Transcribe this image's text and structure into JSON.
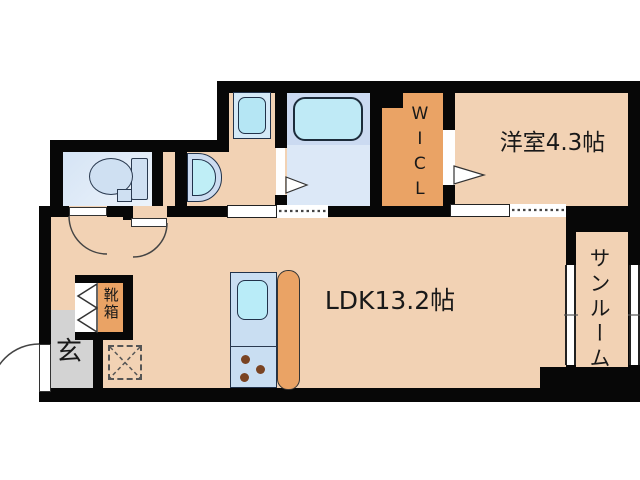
{
  "floorplan": {
    "type": "apartment-floor-plan",
    "labels": {
      "ldk": "LDK13.2帖",
      "western_room": "洋室4.3帖",
      "wicl": "WICL",
      "sunroom": "サンルーム",
      "entrance": "玄",
      "shoe_box": "靴箱"
    },
    "rooms": [
      {
        "name": "LDK",
        "size_tatami": "13.2帖"
      },
      {
        "name": "洋室",
        "size_tatami": "4.3帖"
      },
      {
        "name": "WICL (walk-in closet)",
        "size_tatami": ""
      },
      {
        "name": "サンルーム (sunroom)",
        "size_tatami": ""
      },
      {
        "name": "玄関 (entrance)",
        "size_tatami": ""
      }
    ],
    "fixtures": [
      "toilet",
      "wash-basin",
      "washing-machine-pan",
      "bathtub",
      "kitchen-sink-unit",
      "gas-stove-burners",
      "kitchen-counter",
      "refrigerator-space",
      "shoe-box",
      "entrance-door",
      "bifold-closet-door",
      "hinged-doors",
      "sliding-doors",
      "windows"
    ],
    "colors": {
      "wall": "#070707",
      "room_floor": "#f2d2b4",
      "closet_orange": "#eaa365",
      "entrance_gray": "#d3d3d3",
      "bathroom_floor": "#dce8f7",
      "fixture_blue": "#c9ddf2",
      "water_cyan": "#b9ebf7",
      "text": "#191919"
    }
  }
}
